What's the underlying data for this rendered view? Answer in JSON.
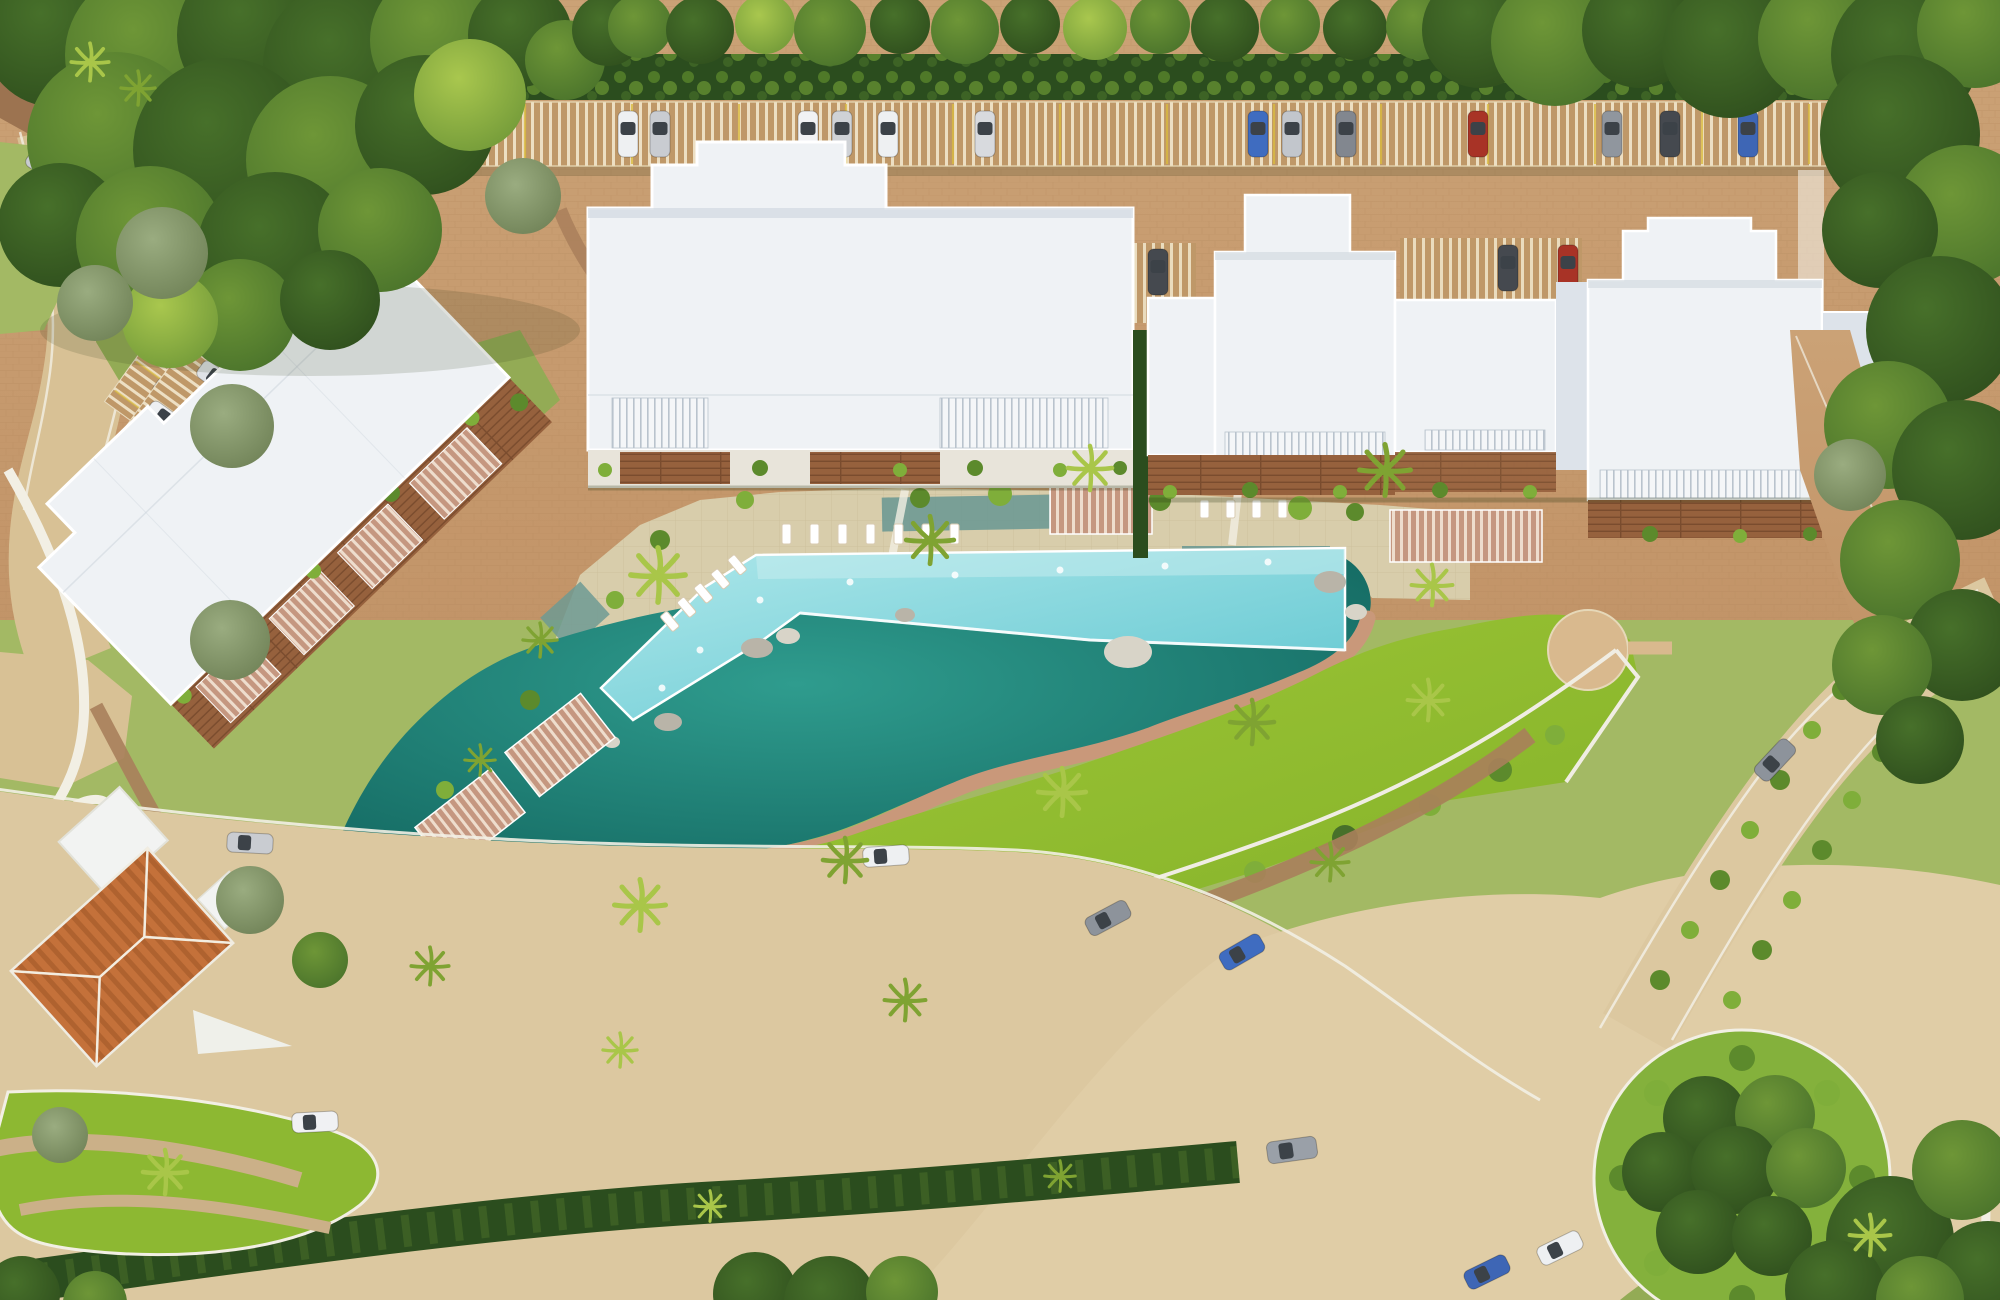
{
  "palette": {
    "tree_dark": "#2d4c1c",
    "tree_mid": "#47702a",
    "tree_light": "#6e9637",
    "tree_bright": "#a9c74e",
    "tree_sage": "#9aac80",
    "sage_dark": "#6d7f54",
    "hedge": "#2b4d1e",
    "bush_bright": "#7fae3a",
    "bush_mid": "#5c8a2c",
    "lawn_a": "#a3ca39",
    "lawn_b": "#7fae27",
    "grass_dull": "#a3b964",
    "grass_dull2": "#93ab55",
    "round_grass": "#84b13c",
    "driveway_a": "#cba276",
    "driveway_b": "#c29468",
    "brick_line": "#b18659",
    "road": "#dcc8a0",
    "plaza": "#e0cda6",
    "road_light": "#d8c195",
    "curb": "#f2efe4",
    "dirt": "#a97f5b",
    "dark_lot": "#9c7350",
    "pergola_base": "#bf9868",
    "pergola_slat": "#efe3c8",
    "parking_line": "#d9ba3e",
    "stone_deck": "#d8cdab",
    "stone_line": "#c3b58e",
    "pool_a": "#aee7ea",
    "pool_b": "#5fc6d0",
    "pool_edge": "#ffffff",
    "lagoon_a": "#2f9c8e",
    "lagoon_b": "#0e5e58",
    "water_pond": "#6f9a93",
    "boardwalk": "#c9987a",
    "roof_white": "#eff2f5",
    "roof_shade": "#dde3ea",
    "roof_line": "#ffffff",
    "roof_gap": "#c9d1da",
    "rail_slat": "#b9c3cd",
    "wood": "#96613d",
    "wood_dark": "#7a4c2e",
    "wood_light": "#b5825a",
    "cabana": "#c59780",
    "cabana_slat": "#eeddcd",
    "terracotta": "#c4713a",
    "terracotta_dark": "#9e5527",
    "annex_white": "#f2f3f2",
    "sand": "#d9b98e",
    "rock": "#b9b4a8",
    "rock_light": "#d8d4c8",
    "car_glass": "#3c4248",
    "fence": "#f0ede3",
    "median_stripe": "#cbb088",
    "palm": "#7fa332",
    "palm_bright": "#a9c649",
    "shadow": "#2a3614"
  },
  "cars": {
    "canopy_row": [
      {
        "color": "#eef0f2"
      },
      {
        "color": "#c9ccd1"
      },
      {
        "color": "#f1f2f4"
      },
      {
        "color": "#cfd2d6"
      },
      {
        "color": "#eef0f2"
      },
      {
        "color": "#d8dade"
      },
      {
        "color": "#3f6cc0"
      },
      {
        "color": "#c2c6cc"
      },
      {
        "color": "#82878f"
      },
      {
        "color": "#a83326"
      },
      {
        "color": "#90969e"
      },
      {
        "color": "#45494f"
      },
      {
        "color": "#3e66b5"
      }
    ],
    "upper_left_lot": [
      {
        "color": "#f0f1f3"
      },
      {
        "color": "#ebedef"
      },
      {
        "color": "#e8eaec"
      },
      {
        "color": "#d98b94"
      },
      {
        "color": "#3f6cc0"
      }
    ],
    "second_lot": [
      {
        "color": "#eef0f2"
      },
      {
        "color": "#dfe2e6"
      }
    ],
    "left_road": [
      {
        "color": "#c9ccd1"
      },
      {
        "color": "#eef0f2"
      }
    ],
    "side_lots": [
      {
        "color": "#eef0f2"
      },
      {
        "color": "#d4d7db"
      },
      {
        "color": "#eef0f2"
      },
      {
        "color": "#45494f"
      },
      {
        "color": "#45494f"
      },
      {
        "color": "#a83326"
      },
      {
        "color": "#3a3e44"
      }
    ],
    "streets": [
      {
        "color": "#c9ccd1"
      },
      {
        "color": "#eef0f2"
      },
      {
        "color": "#f0f1f3"
      },
      {
        "color": "#8d939b"
      },
      {
        "color": "#3f6cc0"
      },
      {
        "color": "#9aa0a8"
      },
      {
        "color": "#3e66b5"
      },
      {
        "color": "#eef0f2"
      },
      {
        "color": "#8d939b"
      }
    ]
  }
}
